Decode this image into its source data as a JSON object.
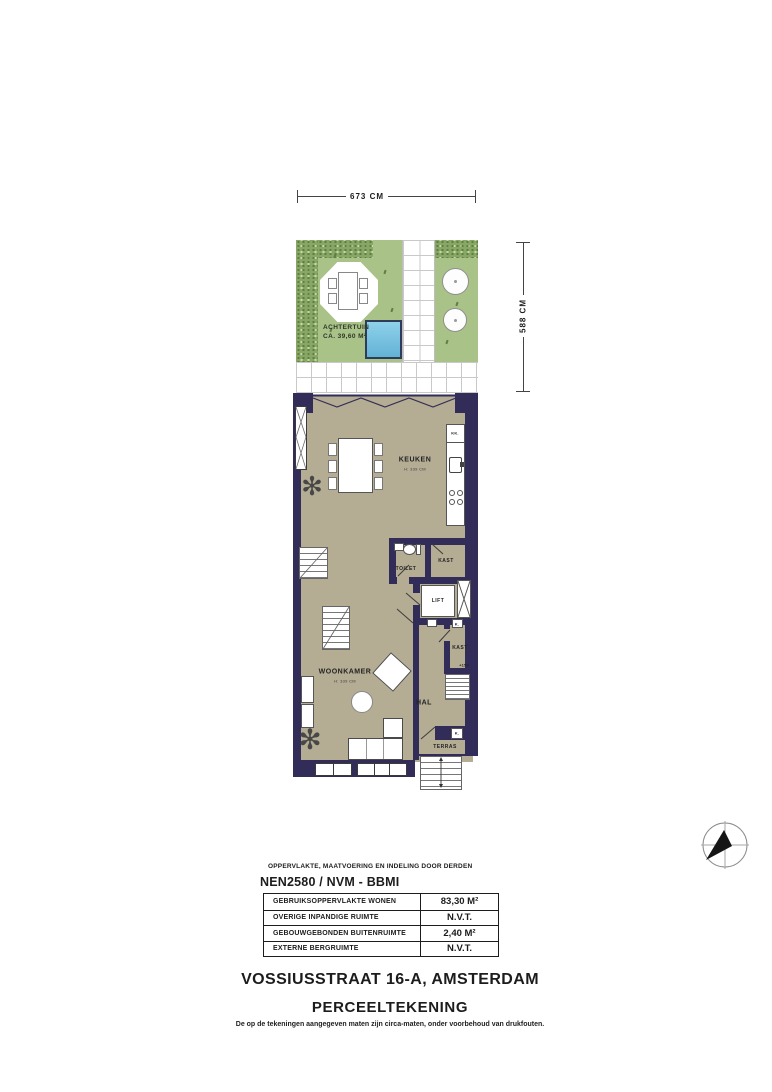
{
  "colors": {
    "wall": "#312d58",
    "floor": "#b4ac93",
    "lawn": "#a9c287",
    "hedge": "#88a766",
    "water": "#7cc2e0"
  },
  "dimensions": {
    "top": "673 CM",
    "right": "588 CM"
  },
  "garden": {
    "label": "ACHTERTUIN",
    "area": "CA. 39,60 M²"
  },
  "rooms": {
    "keuken": {
      "label": "KEUKEN",
      "height": "H: 339 CM"
    },
    "woonkamer": {
      "label": "WOONKAMER",
      "height": "H: 339 CM"
    },
    "hal": {
      "label": "HAL"
    },
    "toilet": {
      "label": "TOILET"
    },
    "kast1": {
      "label": "KAST"
    },
    "kast2": {
      "label": "KAST"
    },
    "lift": {
      "label": "LIFT"
    },
    "terras": {
      "label": "TERRAS"
    },
    "meter1": {
      "label": "K."
    },
    "meter2": {
      "label": "K."
    },
    "stair_note": {
      "label": "+150"
    },
    "fridge": {
      "label": "KK."
    }
  },
  "area_table": {
    "note": "OPPERVLAKTE, MAATVOERING EN INDELING DOOR DERDEN",
    "standard": "NEN2580 / NVM - BBMI",
    "rows": [
      {
        "label": "GEBRUIKSOPPERVLAKTE WONEN",
        "value": "83,30 M²"
      },
      {
        "label": "OVERIGE INPANDIGE RUIMTE",
        "value": "N.V.T."
      },
      {
        "label": "GEBOUWGEBONDEN BUITENRUIMTE",
        "value": "2,40 M²"
      },
      {
        "label": "EXTERNE BERGRUIMTE",
        "value": "N.V.T."
      }
    ]
  },
  "footer": {
    "title": "VOSSIUSSTRAAT 16-A, AMSTERDAM",
    "subtitle": "PERCEELTEKENING",
    "disclaimer": "De op de tekeningen aangegeven maten zijn circa-maten, onder voorbehoud van drukfouten."
  }
}
